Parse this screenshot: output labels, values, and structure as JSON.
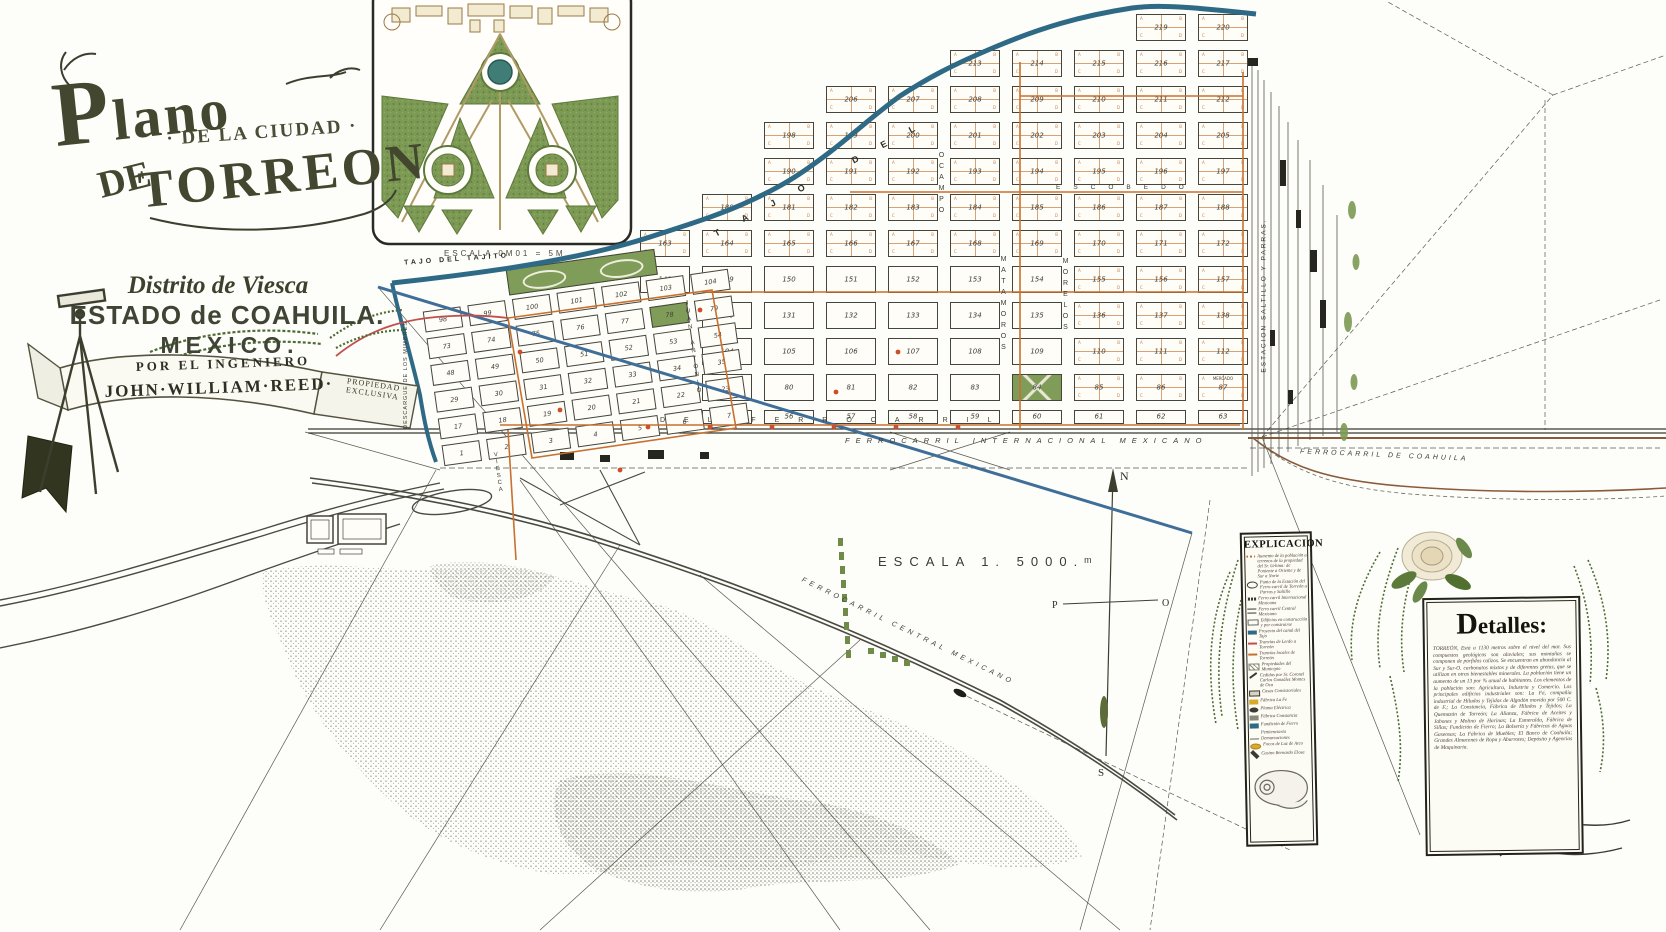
{
  "page": {
    "width": 1666,
    "height": 932
  },
  "title_block": {
    "plano": "Plano",
    "ciudad": "· DE LA CIUDAD ·",
    "de": "DE",
    "torreon": "TORREON",
    "district": "Distrito de Viesca",
    "state": "ESTADO de COAHUILA.",
    "country": "MEXICO.",
    "byline": "POR EL INGENIERO",
    "author": "JOHN·WILLIAM·REED·",
    "property": "PROPIEDAD EXCLUSIVA"
  },
  "inset": {
    "caption": "ESCALA 0M01 = 5M"
  },
  "scale_label": "ESCALA 1. 5000.ᵐ",
  "compass": {
    "n": "N",
    "s": "S",
    "w": "P",
    "e": "O"
  },
  "railways": {
    "internacional": "FERROCARRIL INTERNACIONAL MEXICANO",
    "central": "FERROCARRIL CENTRAL MEXICANO",
    "coahuila": "FERROCARRIL DE COAHUILA"
  },
  "canals": {
    "tajo_upper": "TAJO DEL",
    "tajo": "TAJO DEL TAJITO",
    "descargue": "DESCARGUE DE LOS MIMBRES"
  },
  "station": "ESTACION SALTILLO Y PARRAS.",
  "streets": {
    "horizontal": "DEL FERROCARRIL",
    "escobedo": "ESCOBEDO",
    "ocampo": "OCAMPO",
    "matamoros": "MATAMOROS",
    "morelos": "MORELOS",
    "juan_antonio": "JUAN ANTONIO",
    "viesca": "VIESCA"
  },
  "mercado_label": "MERCADO",
  "quad_letters": [
    "A",
    "B",
    "C",
    "D"
  ],
  "new_grid": {
    "x0": 640,
    "y0": 14,
    "colW": 62,
    "rowH": 36,
    "blockW": 50,
    "blockH": 27,
    "rows": [
      {
        "start": 8,
        "nums": [
          219,
          220
        ]
      },
      {
        "start": 5,
        "nums": [
          213,
          214,
          215,
          216,
          217
        ]
      },
      {
        "start": 3,
        "nums": [
          206,
          207,
          208,
          209,
          210,
          211,
          212
        ]
      },
      {
        "start": 2,
        "nums": [
          198,
          199,
          200,
          201,
          202,
          203,
          204,
          205
        ]
      },
      {
        "start": 2,
        "nums": [
          190,
          191,
          192,
          193,
          194,
          195,
          196,
          197
        ]
      },
      {
        "start": 1,
        "nums": [
          180,
          181,
          182,
          183,
          184,
          185,
          186,
          187,
          188
        ]
      },
      {
        "start": 0,
        "nums": [
          163,
          164,
          165,
          166,
          167,
          168,
          169,
          170,
          171,
          172
        ]
      },
      {
        "start": 0,
        "nums": [
          148,
          149,
          150,
          151,
          152,
          153,
          154,
          155,
          156,
          157
        ]
      },
      {
        "start": 1,
        "nums": [
          130,
          131,
          132,
          133,
          134,
          135,
          136,
          137,
          138
        ]
      },
      {
        "start": 1,
        "nums": [
          104,
          105,
          106,
          107,
          108,
          109,
          110,
          111,
          112
        ]
      },
      {
        "start": 1,
        "nums": [
          79,
          80,
          81,
          82,
          83,
          84,
          85,
          86,
          87
        ]
      },
      {
        "start": 1,
        "half": true,
        "nums": [
          55,
          56,
          57,
          58,
          59,
          60,
          61,
          62,
          63
        ]
      }
    ]
  },
  "old_grid": {
    "y0": 34,
    "rowH": 27,
    "colW": 45,
    "blockW": 38,
    "blockH": 21,
    "rows": [
      [
        98,
        99,
        100,
        101,
        102,
        103,
        104
      ],
      [
        73,
        74,
        75,
        76,
        77,
        78,
        79
      ],
      [
        48,
        49,
        50,
        51,
        52,
        53,
        54
      ],
      [
        29,
        30,
        31,
        32,
        33,
        34,
        35
      ],
      [
        17,
        18,
        19,
        20,
        21,
        22,
        23
      ],
      [
        1,
        2,
        3,
        4,
        5,
        6,
        7
      ]
    ],
    "park_nums": [
      78
    ]
  },
  "legend": {
    "title": "EXPLICACION",
    "items": [
      {
        "sym": "dotline",
        "text": "Aumento de la población a terrenos de la propiedad del Sr. Urbina: de Poniente a Oriente y de Sur a Norte"
      },
      {
        "sym": "target",
        "text": "Punto de la Estación del Ferro-carril de Torreón a Parras y Saltillo"
      },
      {
        "sym": "rail",
        "text": "Ferro carril Internacional Mexicano"
      },
      {
        "sym": "rail2",
        "text": "Ferro carril Central Mexicano"
      },
      {
        "sym": "bldg",
        "text": "Edificios en construcción y por construirse"
      },
      {
        "sym": "canal",
        "text": "Proyecto del canal del Tajo"
      },
      {
        "sym": "red",
        "text": "Tranvías de Lerdo a Torreón"
      },
      {
        "sym": "orange",
        "text": "Tranvías locales de Torreón"
      },
      {
        "sym": "hatch",
        "text": "Propiedades del Municipio"
      },
      {
        "sym": "pen",
        "text": "Cedidas por Sr. Coronel Carlos González Montes de Oca"
      },
      {
        "sym": "house",
        "text": "Casas Consistoriales"
      },
      {
        "sym": "ylw",
        "text": "Fábrica La Fe"
      },
      {
        "sym": "blk",
        "text": "Planta Eléctrica"
      },
      {
        "sym": "gry",
        "text": "Fábrica Constancia"
      },
      {
        "sym": "teal",
        "text": "Fundición de Fierro"
      },
      {
        "sym": "pent",
        "text": "Penitenciaría"
      },
      {
        "sym": "line",
        "text": "Demarcaciones"
      },
      {
        "sym": "dot",
        "text": "Focos de Luz de Arco"
      },
      {
        "sym": "cas",
        "text": "Casino Bernardo Elosa"
      }
    ]
  },
  "details": {
    "title": "Detalles:",
    "body": "TORREÓN, Está a 1130 metros sobre el nivel del mar. Sus compuestos geológicos son aluviales; sus montañas se componen de pórfidos calizos. Se encuentran en abundancia al Sur y Sur-O. carbonatos mixtos y de diferentes gretas, que se utilizan en otras bienestables minerales. La población tiene un aumento de un 13 por % anual de habitantes. Los elementos de la población son: Agricultura, Industria y Comercio. Los principales edificios industriales son: La Fé, compañía industrial de Hilados y Tejidos de Algodón movida por 500 C. de F.; La Constancia, Fábrica de Hilados y Tejidos; La Quemazón de Torreón; La Alianza, Fábrica de Aceites y Jabones y Molino de Harinas; La Esmeralda, Fábrica de Sillas; Fundición de Fierro; La Bolsería y Fábricas de Aguas Gaseosas; La Fábrica de Muebles; El Banco de Coahuila; Grandes Almacenes de Ropa y Abarrotes; Depósito y Agencias de Maquinaria."
  },
  "colors": {
    "canal_teal": "#2e6a85",
    "project_blue": "#3f6f99",
    "tram_orange": "#c8702f",
    "tram_red": "#c0504d",
    "rail_brown": "#8a5a3c",
    "park_green": "#7f9c58",
    "ink": "#3a3a30"
  }
}
